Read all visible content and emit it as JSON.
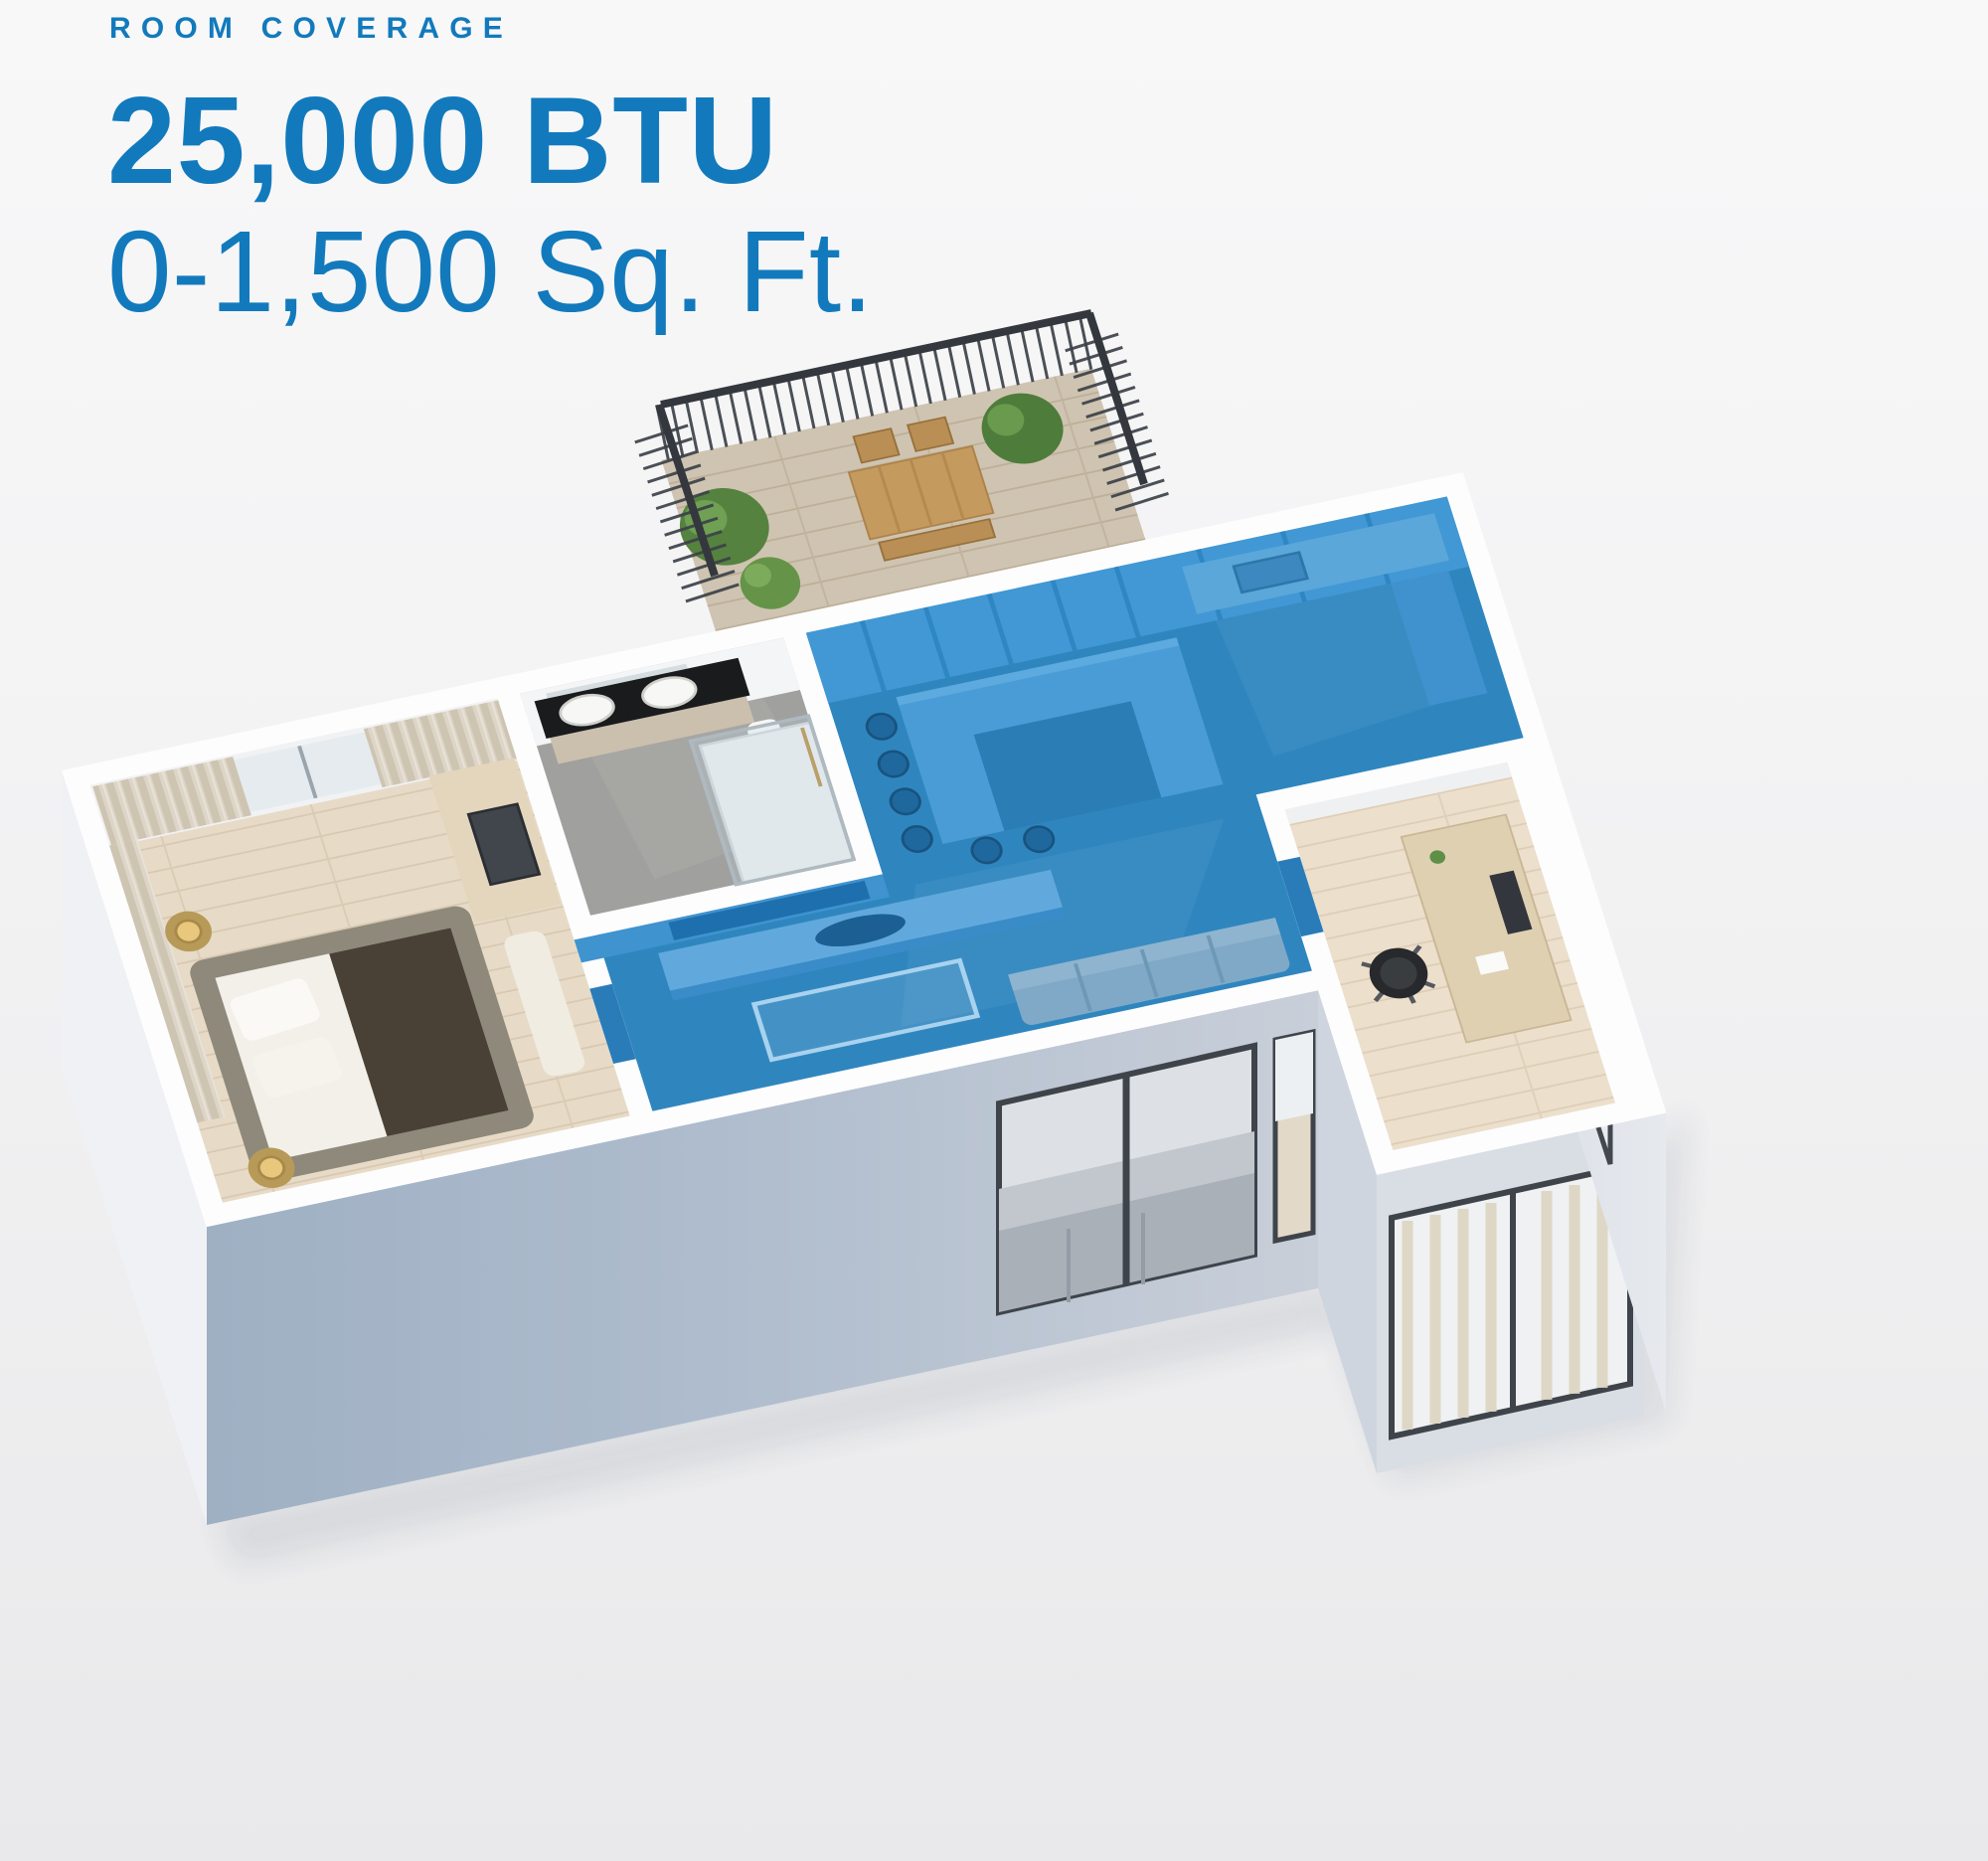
{
  "header": {
    "eyebrow": "ROOM COVERAGE",
    "btu_rating": "25,000 BTU",
    "coverage_range": "0-1,500 Sq. Ft."
  },
  "colors": {
    "headline_blue": "#127abc",
    "coverage_overlay_wall_blue": "#4198d4",
    "coverage_overlay_floor_blue": "#2f86bf",
    "facade_gray_blue": "#9fb0c3",
    "facade_light_gray": "#c9cfd9",
    "wall_white": "#fdfdfe",
    "wood_floor": "#e7dbc7",
    "background_top": "#f8f8f9",
    "background_bottom": "#e9e9eb"
  },
  "floorplan": {
    "type": "isometric-3d-apartment-render",
    "covered_rooms": [
      "kitchen",
      "dining-area",
      "living-room",
      "hallway"
    ],
    "uncovered_rooms": [
      "bedroom",
      "bathroom",
      "office",
      "balcony"
    ]
  }
}
